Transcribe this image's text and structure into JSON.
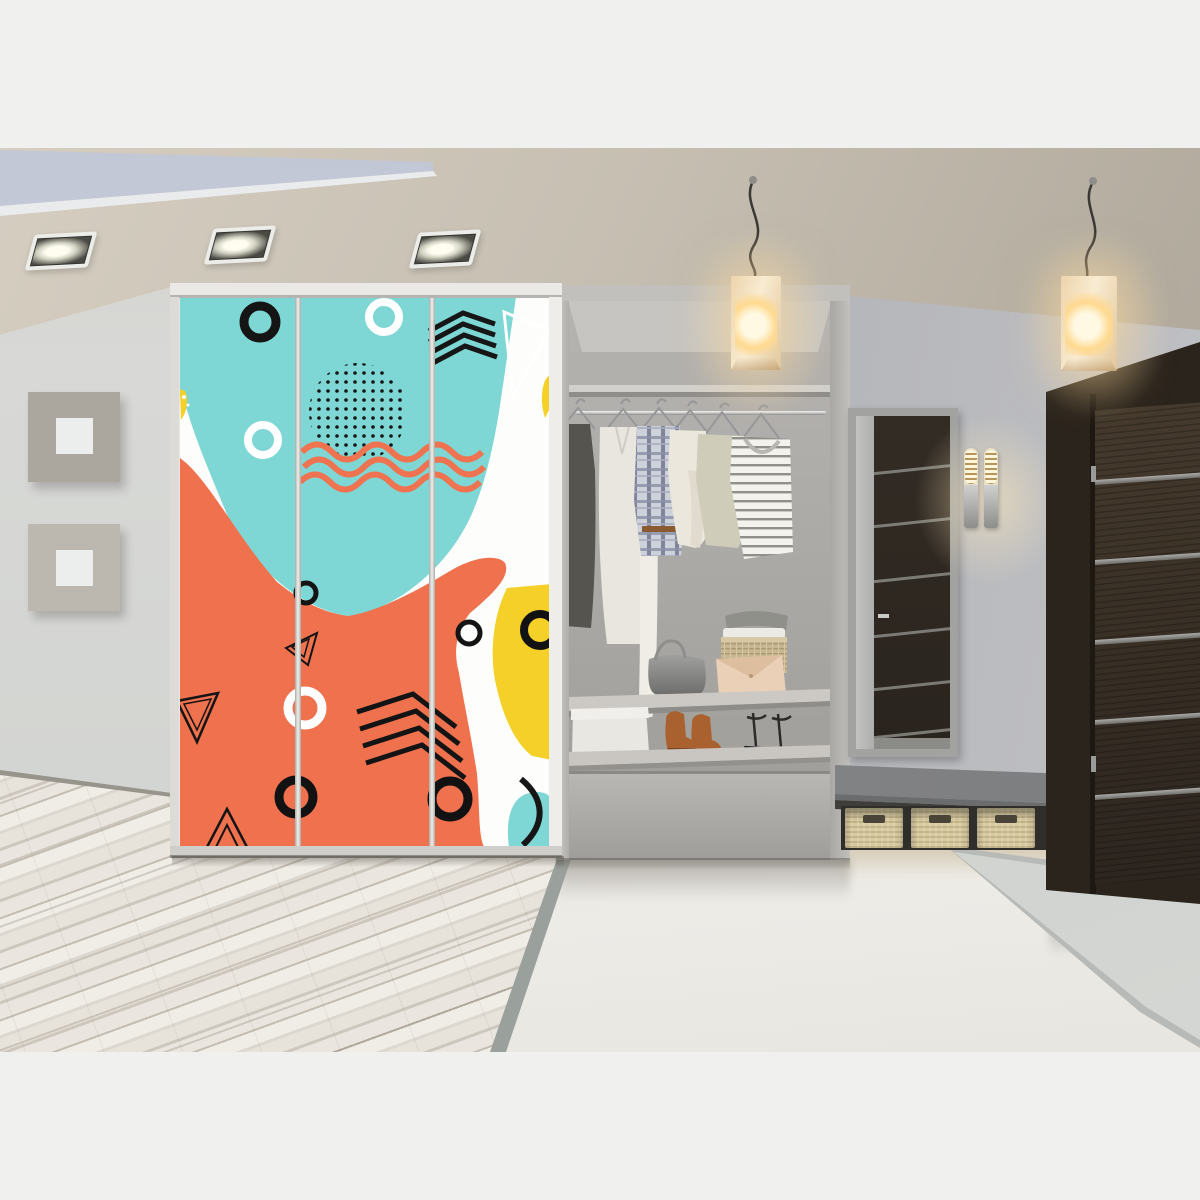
{
  "meta": {
    "kind": "photorealistic interior rendering, no text in image",
    "canvas": {
      "width": 1200,
      "height": 1200
    },
    "photo_area": {
      "x": 0,
      "y": 148,
      "width": 1200,
      "height": 904
    }
  },
  "palette": {
    "background": "#f0f0ee",
    "ceiling": "#d6cfc2",
    "cove": "#d2d6e1",
    "wall_left": "#d8d9d6",
    "wall_right": "#b0b1b5",
    "wardrobe_teal": "#7ed7d4",
    "wardrobe_orange": "#f0714e",
    "wardrobe_yellow": "#f4d028",
    "pattern_black": "#161616",
    "pattern_white": "#ffffff",
    "unit_grey": "#b7b5b2",
    "niche_back": "#a9a7a4",
    "door_wood": "#2b241c",
    "door_stripe": "#6f6d68",
    "mirror_frame": "#a2a2a0",
    "floor_wood": "#f0ede7",
    "floor_gloss": "#e6e3dc",
    "rug": "#d8dad7",
    "basket": "#d9cba1",
    "bench": "#7b7c7e",
    "lamp_warm": "#ffd98f",
    "sconce_warm": "#fff6da",
    "boots_brown": "#a9622f",
    "clutch_beige": "#ead0b6"
  },
  "scene": {
    "room": "modern hallway / entryway",
    "objects": [
      {
        "name": "wardrobe",
        "desc": "three-panel sliding wardrobe with Memphis-style abstract print: teal and orange blobs, yellow accents, black rings, triangles, chevrons, dotted circle, orange waves"
      },
      {
        "name": "closet-unit",
        "desc": "open grey closet niche with top shelf, chrome rail, six hanging garments (dark dress, white dress, white robe, plaid shirt, cream sweater, sage sweater, striped tee)"
      },
      {
        "name": "closet-shelf-items",
        "desc": "grey handbag, beige envelope clutch, wicker basket with folded towels and grey knit on middle shelf; white box, brown chukka boots, black strappy heels on lower shelf"
      },
      {
        "name": "pendant-lamps",
        "desc": "two cube-shaped warm glowing pendant lamps on squiggly dark cords"
      },
      {
        "name": "ceiling-spotlights",
        "desc": "three recessed square spotlights and a recessed light cove near the left wall"
      },
      {
        "name": "wall-frames",
        "desc": "two square grey frames with white centers on the left wall"
      },
      {
        "name": "mirror",
        "desc": "tall grey-framed mirror reflecting a dark striped door"
      },
      {
        "name": "wall-sconce",
        "desc": "double-cylinder chrome sconce with glowing ribbed diffusers"
      },
      {
        "name": "bench",
        "desc": "grey bench ledge with three tan wicker baskets underneath"
      },
      {
        "name": "entry-door",
        "desc": "dark wenge wood door with five horizontal aluminum inlays"
      },
      {
        "name": "floors",
        "desc": "whitewashed diagonal plank floor in front of wardrobe, glossy cream tile elsewhere, grey runner rug by the door"
      }
    ]
  }
}
